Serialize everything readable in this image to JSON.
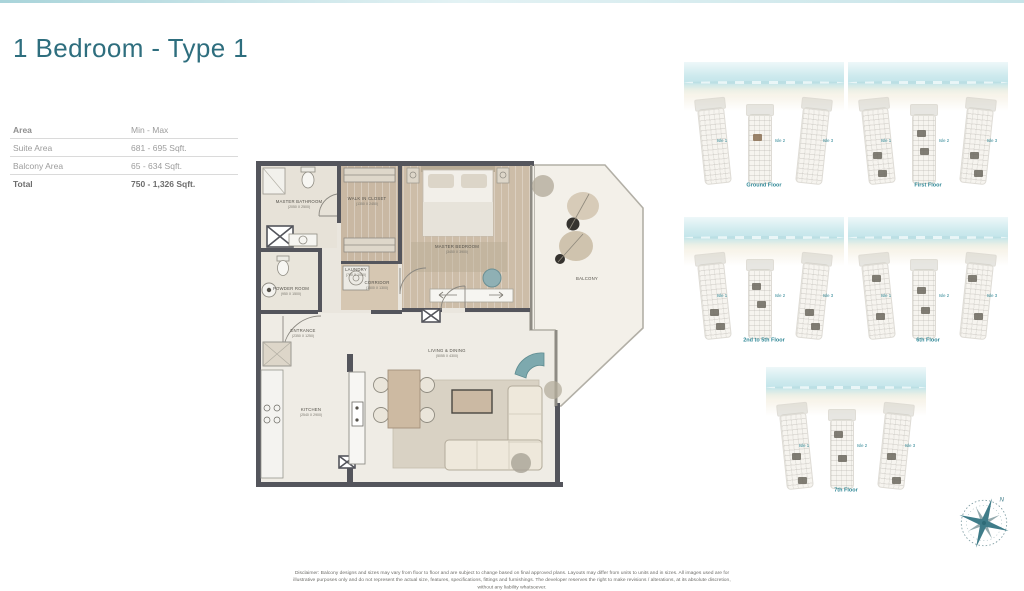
{
  "page": {
    "title": "1 Bedroom - Type 1",
    "disclaimer": "Disclaimer: Balcony designs and sizes may vary from floor to floor and are subject to change based on final approved plans. Layouts may differ from units to units and in sizes. All images used are for illustrative purposes only and do not represent the actual size, features, specifications, fittings and furnishings. The developer reserves the right to make revisions / alterations, at its absolute discretion, without any liability whatsoever."
  },
  "area_table": {
    "header_label": "Area",
    "header_value": "Min - Max",
    "rows": [
      {
        "label": "Suite Area",
        "value": "681 - 695 Sqft."
      },
      {
        "label": "Balcony Area",
        "value": "65 - 634 Sqft."
      },
      {
        "label": "Total",
        "value": "750 - 1,326 Sqft."
      }
    ]
  },
  "floor_plan": {
    "rooms": [
      {
        "name": "MASTER BATHROOM",
        "dims": "(2050 X 2500)"
      },
      {
        "name": "WALK IN CLOSET",
        "dims": "(1350 X 2450)"
      },
      {
        "name": "LAUNDRY",
        "dims": "(700 X 1050)"
      },
      {
        "name": "CORRIDOR",
        "dims": "(1500 X 1300)"
      },
      {
        "name": "POWDER ROOM",
        "dims": "(950 X 1500)"
      },
      {
        "name": "MASTER BEDROOM",
        "dims": "(3450 X 3900)"
      },
      {
        "name": "ENTRANCE",
        "dims": "(2350 X 1250)"
      },
      {
        "name": "KITCHEN",
        "dims": "(2540 X 2900)"
      },
      {
        "name": "LIVING & DINING",
        "dims": "(5055 X 4300)"
      },
      {
        "name": "BALCONY",
        "dims": ""
      }
    ]
  },
  "key_plans": [
    {
      "label": "Ground Floor",
      "isles": [
        "Isle 1",
        "Isle 2",
        "Isle 3"
      ]
    },
    {
      "label": "First Floor",
      "isles": [
        "Isle 1",
        "Isle 2",
        "Isle 3"
      ]
    },
    {
      "label": "2nd to 5th Floor",
      "isles": [
        "Isle 1",
        "Isle 2",
        "Isle 3"
      ]
    },
    {
      "label": "6th Floor",
      "isles": [
        "Isle 1",
        "Isle 2",
        "Isle 3"
      ]
    },
    {
      "label": "7th Floor",
      "isles": [
        "Isle 1",
        "Isle 2",
        "Isle 3"
      ]
    }
  ],
  "compass": {
    "north": "N"
  },
  "colors": {
    "accent_teal": "#2e6e7e",
    "isle_teal": "#2f8796",
    "wall": "#54555c",
    "water": "#c3e5ea"
  }
}
